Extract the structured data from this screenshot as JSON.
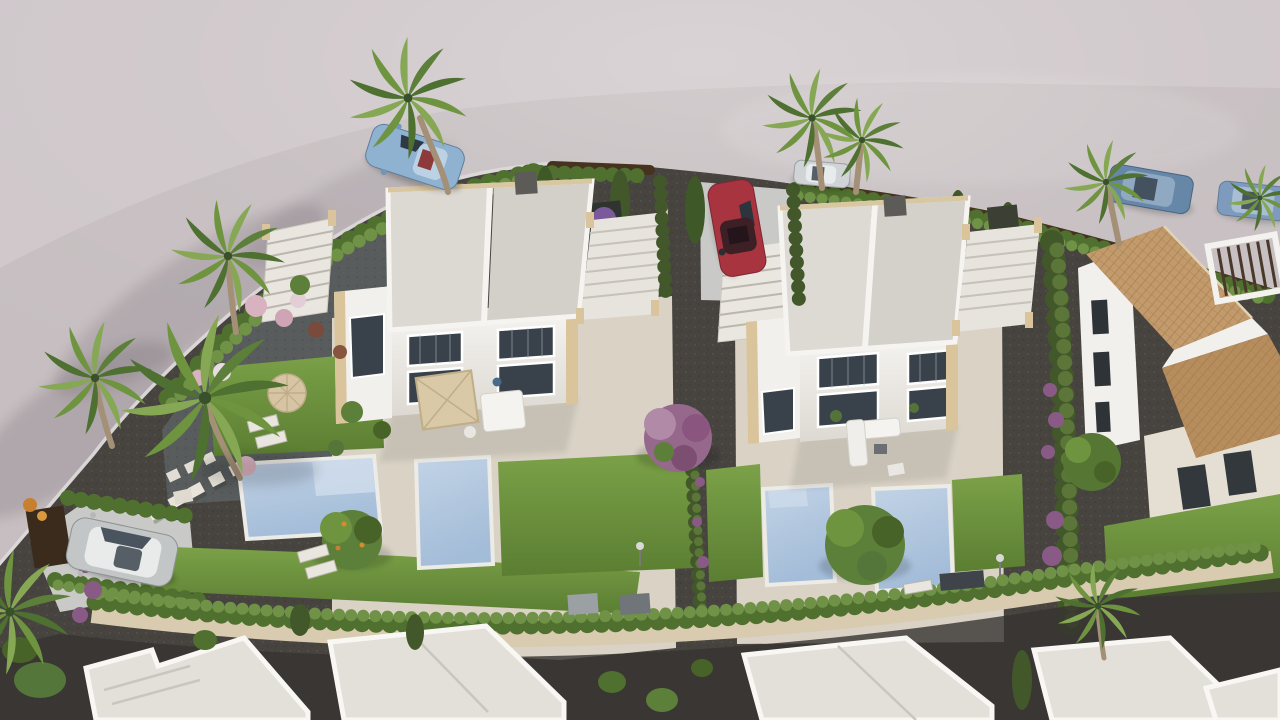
{
  "meta": {
    "title": "Aerial 3D render of coastal residential development",
    "type": "architectural-visualization",
    "text_visible": "none"
  },
  "scene": {
    "description": "Bird's-eye 3D rendering: two white duplex villas with flat solarium roofs and exterior stairs, four private swimming pools, lawns, gravel gardens, cypress hedges, palm trees, a terracotta tile-roof house at right, curving asphalt street at top, parked cars, beige boundary wall with hedge and white flat roofs of neighbouring houses along the bottom.",
    "objects": {
      "street": "curving asphalt road wrapping the plot on top and left",
      "villa_left": "white two-storey duplex villa with grey flat roof, external staircases and roof terrace",
      "villa_right": "white two-storey duplex villa with grey flat roof, external staircases and roof terrace",
      "terracotta_house": "white villa with clay tile hip roofs and slatted pergola, far right",
      "pools": "4 rectangular private pools, light blue water",
      "cars": [
        "light-blue coupe on street",
        "silver car under palms",
        "navy SUV top right",
        "steel-blue sedan far right",
        "red car in driveway",
        "silver SUV in left driveway"
      ],
      "palms": "9 palm trees",
      "trees": [
        "purple bougainvillea tree between villas",
        "green fruit tree by left pools",
        "large green tree by right pools",
        "green tree on right gravel strip",
        "banana palm bottom right"
      ],
      "garden": "round parasol with two sun loungers, square terrace parasols, white outdoor sofas, stepping-stone path, flowering shrubs",
      "boundary": "dark brown fence with hedge row on top edge, beige wall with hedge along bottom",
      "neighbour_roofs": "five white flat roofs cut by bottom edge"
    }
  },
  "palette": {
    "road": "#c6bec0",
    "roadFar": "#d4cdcf",
    "curb": "#ded9da",
    "plotGravel": "#474440",
    "gardenGravel": "#585c5d",
    "paving": "#d9d2c5",
    "terrace": "#e4ded3",
    "driveway": "#c9cac7",
    "lawn": "#6f9440",
    "lawnDeep": "#597c31",
    "hedge": "#50702f",
    "hedgeLight": "#6f9247",
    "cypress": "#42582a",
    "fence": "#45321f",
    "wall": "#d8cbb0",
    "roof": "#d8d4ce",
    "parapet": "#f6f4f1",
    "coping": "#d9c7a2",
    "facade": "#f2f0ed",
    "window": "#39424b",
    "sandstone": "#d9c49c",
    "pool": "#b3c8df",
    "poolLight": "#d3e0ee",
    "terracotta": "#c29a6c",
    "terracottaDark": "#b78d5e",
    "treeGreen": "#5c7f39",
    "treePurple": "#96688c",
    "blossom": "#d9b2c0",
    "purpleFlower": "#8a5a86",
    "trunk": "#a39076",
    "carBlue": "#8fb2d1",
    "carRed": "#a83440",
    "carSilver": "#c3c6c6",
    "carNavy": "#6787a9",
    "carSteel": "#7e9abc",
    "carSmall": "#d0d4d6",
    "whiteRoof": "#e3e0da",
    "chimney": "#5d5b58"
  }
}
